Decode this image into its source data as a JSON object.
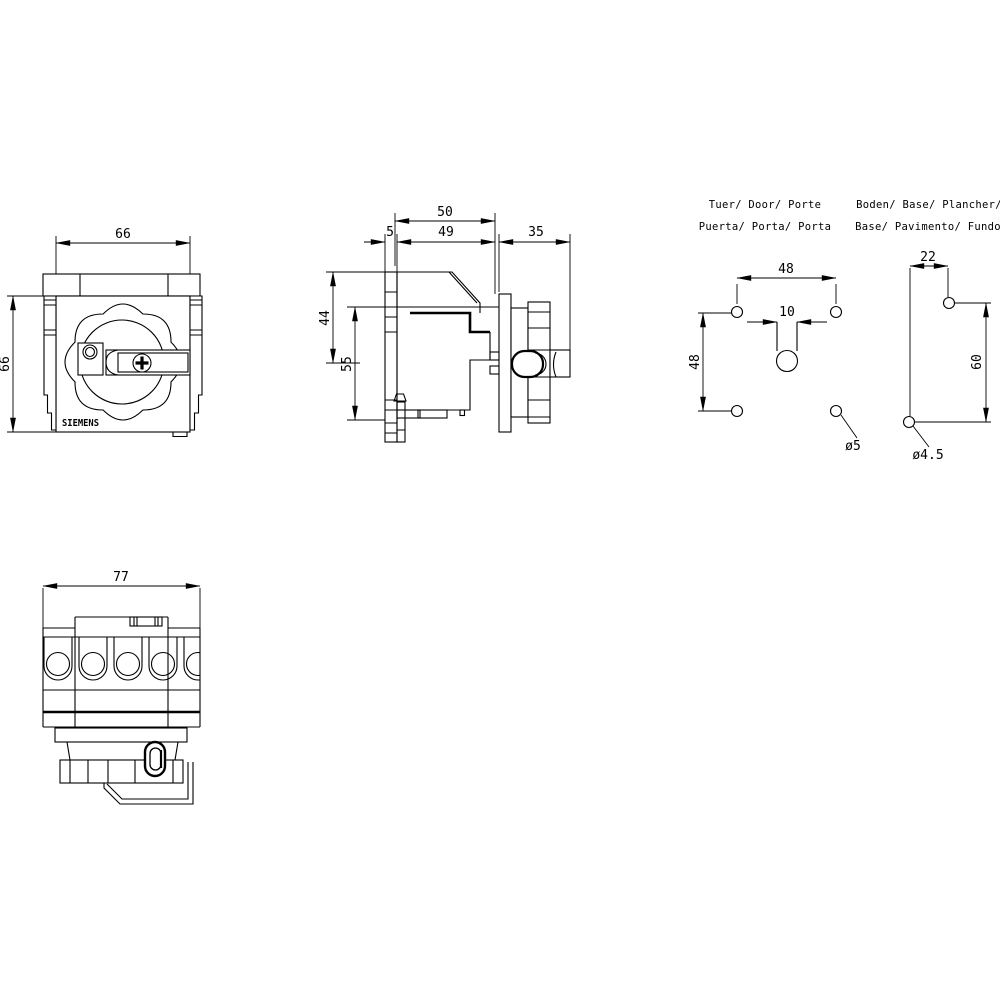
{
  "drawing": {
    "background": "#ffffff",
    "line_color": "#000000",
    "brand_label": "SIEMENS",
    "front_view": {
      "dim_width": "66",
      "dim_height": "66"
    },
    "side_view": {
      "dim_depth_total": "50",
      "dim_plate": "5",
      "dim_body_depth": "49",
      "dim_knob_depth": "35",
      "dim_upper_height": "44",
      "dim_lower_height": "55"
    },
    "door_pattern": {
      "title_line1": "Tuer/ Door/ Porte",
      "title_line2": "Puerta/ Porta/ Porta",
      "dim_hole_spacing_h": "48",
      "dim_hole_spacing_v": "48",
      "dim_slot_width": "10",
      "hole_diameter": "ø5"
    },
    "base_pattern": {
      "title_line1": "Boden/ Base/ Plancher/",
      "title_line2": "Base/ Pavimento/ Fundo",
      "dim_hole_spacing_h": "22",
      "dim_hole_spacing_v": "60",
      "hole_diameter": "ø4.5"
    },
    "bottom_view": {
      "dim_width": "77"
    }
  }
}
